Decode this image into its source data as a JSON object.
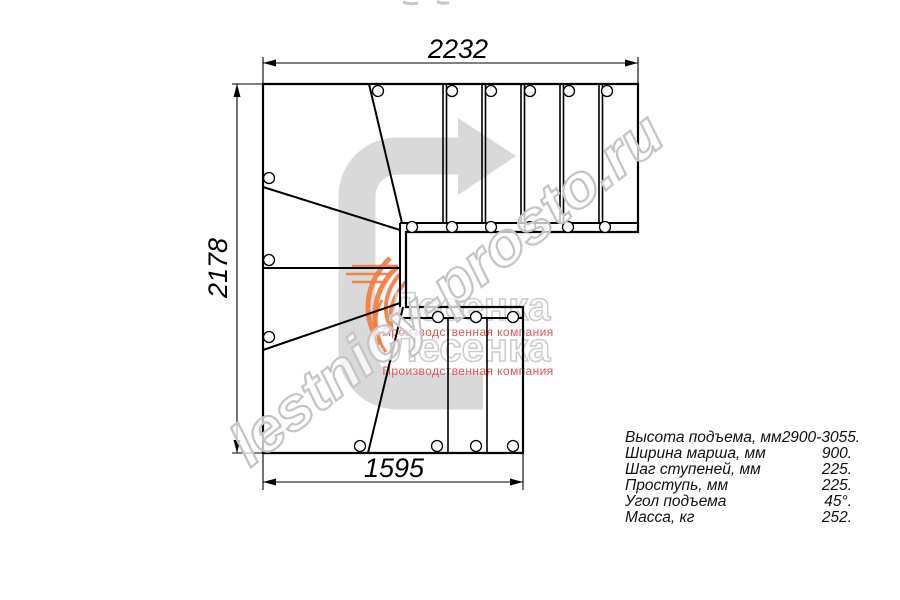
{
  "plan": {
    "dimension_labels": {
      "width_top_mm": "2232",
      "height_left_mm": "2178",
      "width_bottom_mm": "1595"
    }
  },
  "specs": {
    "rows": [
      {
        "label": "Высота подъема, мм",
        "value": "2900-3055."
      },
      {
        "label": "Ширина марша, мм",
        "value": "900."
      },
      {
        "label": "Шаг ступеней, мм",
        "value": "225."
      },
      {
        "label": "Проступь, мм",
        "value": "225."
      },
      {
        "label": "Угол подъема",
        "value": "45°."
      },
      {
        "label": "Масса, кг",
        "value": "252."
      }
    ]
  },
  "watermark": {
    "site": "lestnicy-prosto.ru",
    "logo_text": "Лесенка",
    "logo_caption": "Производственная компания"
  },
  "colors": {
    "line": "#000000",
    "direction_arrow_gray": "#d9d9d9",
    "watermark_gray": "#c5c5c5",
    "logo_red": "#e0554d",
    "flame_orange": "#ef7c3e"
  }
}
